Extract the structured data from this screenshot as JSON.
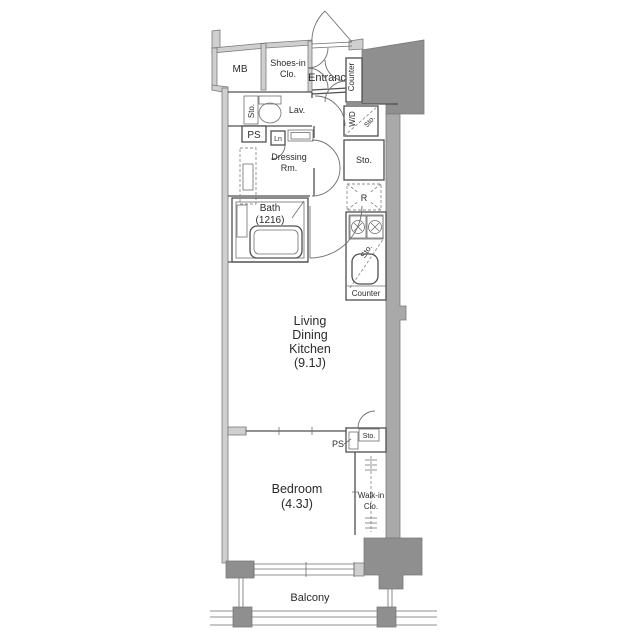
{
  "colors": {
    "bg": "#ffffff",
    "wall-fill": "#cfcfcf",
    "wall-strong": "#a9a9a9",
    "block-fill": "#8f8f8f",
    "wall-stroke": "#7a7a7a",
    "line": "#4f4f4f",
    "thin": "#6f6f6f",
    "dash": "#8f8f8f",
    "text": "#2b2b2b"
  },
  "labels": {
    "mb": "MB",
    "shoes_clo": [
      "Shoes-in",
      "Clo."
    ],
    "entrance": "Entrance",
    "counter_entry": "Counter",
    "sto_lav": "Sto.",
    "lav": "Lav.",
    "ps_upper": "PS",
    "linen": "Ln",
    "wd": "W/D",
    "sto_wd": "Sto.",
    "sto_hall": "Sto.",
    "dressing": [
      "Dressing",
      "Rm."
    ],
    "bath": [
      "Bath",
      "(1216)"
    ],
    "fridge": "R",
    "sto_kitchen": "Sto.",
    "counter_kitchen": "Counter",
    "ldk": [
      "Living",
      "Dining",
      "Kitchen",
      "(9.1J)"
    ],
    "ps_lower": "PS",
    "sto_bedroom": "Sto.",
    "bedroom": [
      "Bedroom",
      "(4.3J)"
    ],
    "wic": [
      "Walk-in",
      "Clo."
    ],
    "balcony": "Balcony"
  }
}
